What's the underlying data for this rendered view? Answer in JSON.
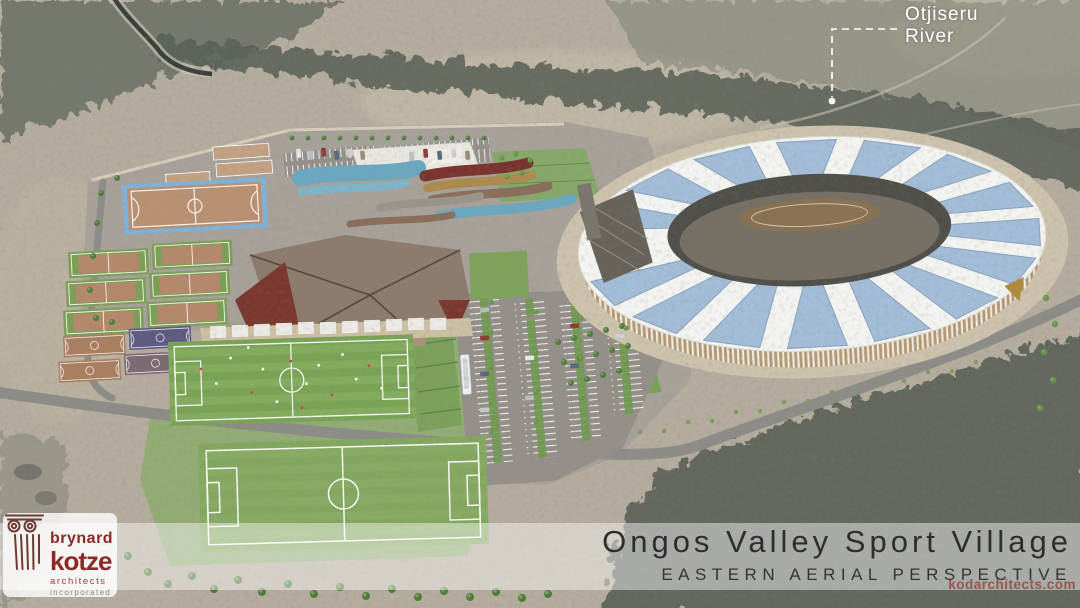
{
  "annotations": {
    "river": {
      "line1": "Otjiseru",
      "line2": "River"
    }
  },
  "caption": {
    "title": "Ongos Valley Sport Village",
    "subtitle": "EASTERN AERIAL PERSPECTIVE"
  },
  "watermark": {
    "text": "kodarchitects.com"
  },
  "logo": {
    "line1": "brynard",
    "line2": "kotze",
    "line3": "architects",
    "line4": "incorporated"
  },
  "colors": {
    "desert": "#b4ac9d",
    "scrub_dark": "#5d645a",
    "scrub_mid": "#7a7f72",
    "site_pavement": "#a7a199",
    "concourse": "#cdc2ad",
    "stadium_roof_white": "#f3f3f0",
    "stadium_roof_glass": "#a3bdd8",
    "stadium_facade_timber": "#c4b193",
    "grass": "#93ab74",
    "field_green": "#7aa355",
    "field_green_alt": "#84ac5e",
    "clay": "#b5886b",
    "court_green": "#7c9f55",
    "hockey_blue": "#7fb2d9",
    "maroon_roof": "#7b332e",
    "teal_roof": "#6ba8c0",
    "gold_roof": "#ad8a4d",
    "brown_roof": "#8d7b6d",
    "road": "#8d8c88",
    "tree_dark": "#4e7a3b",
    "tree_light": "#67944c",
    "bush_olive": "#7c9a5d",
    "logo_red": "#8b2a26",
    "title_text": "#2e2e2e",
    "watermark_red": "#8f1f1a"
  }
}
